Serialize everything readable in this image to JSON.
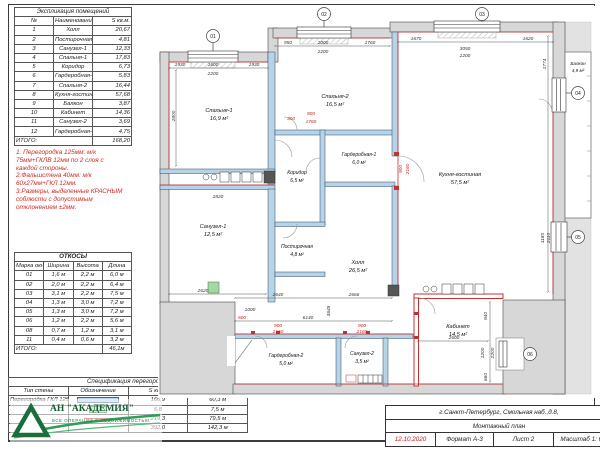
{
  "explication": {
    "title": "Экспликация помещений",
    "headers": [
      "№",
      "Наименование",
      "S кв.м."
    ],
    "rows": [
      [
        "1",
        "Холл",
        "20,67"
      ],
      [
        "2",
        "Постирочная",
        "4,81"
      ],
      [
        "3",
        "Санузел-1",
        "12,33"
      ],
      [
        "4",
        "Спальня-1",
        "17,83"
      ],
      [
        "5",
        "Коридор",
        "6,73"
      ],
      [
        "6",
        "Гардеробная-1",
        "5,83"
      ],
      [
        "7",
        "Спальня-2",
        "16,44"
      ],
      [
        "8",
        "Кухня-гостиная",
        "57,68"
      ],
      [
        "9",
        "Балкон",
        "3,87"
      ],
      [
        "10",
        "Кабинет",
        "14,36"
      ],
      [
        "11",
        "Санузел-2",
        "3,69"
      ],
      [
        "12",
        "Гардеробная-2",
        "4,75"
      ]
    ],
    "total_label": "ИТОГО:",
    "total": "168,20"
  },
  "notes": {
    "line1": "1. Перегородка 125мм: м/к",
    "line2": "75мм+ГКЛВ 12мм по 2 слоя с",
    "line3": "каждой стороны.",
    "line4": "2.Фальшстена 40мм: м/к",
    "line5": "60х27мм+ГКЛ 12мм.",
    "line6": "3.Размеры, выделенные КРАСНЫМ",
    "line7": "соблюсти  с допустимым",
    "line8": "отклонением ±2мм."
  },
  "slopes": {
    "title": "ОТКОСЫ",
    "headers": [
      "Марка окна",
      "Ширина",
      "Высота",
      "Длина"
    ],
    "rows": [
      [
        "01",
        "1,6 м",
        "2,2 м",
        "6,0 м"
      ],
      [
        "02",
        "2,0 м",
        "2,2 м",
        "6,4 м"
      ],
      [
        "03",
        "3,1 м",
        "2,2 м",
        "7,5 м"
      ],
      [
        "04",
        "1,3 м",
        "3,0 м",
        "7,2 м"
      ],
      [
        "05",
        "1,3 м",
        "3,0 м",
        "7,2 м"
      ],
      [
        "06",
        "1,2 м",
        "2,2 м",
        "5,6 м"
      ],
      [
        "08",
        "0,7 м",
        "1,2 м",
        "3,1 м"
      ],
      [
        "11",
        "0,4 м",
        "0,6 м",
        "3,2 м"
      ]
    ],
    "total_label": "ИТОГО:",
    "total": "46,1м"
  },
  "partitions_spec": {
    "title": "Спецификация перегородок",
    "headers": [
      "Тип стены",
      "Обозначение",
      "S кв.м.",
      "Длина"
    ],
    "rows": [
      {
        "type": "Перегородка ГКЛ 125мм",
        "area": "166,9",
        "length": "60,3 м"
      },
      {
        "type": "",
        "area": "5,8",
        "length": "7,5 м"
      },
      {
        "type": "",
        "area": "219,3",
        "length": "79,5 м"
      }
    ],
    "total_area": "392,0",
    "total_length": "142,3 м"
  },
  "logo": {
    "name": "АН \"АКАДЕМИЯ\"",
    "tagline": "ВСЕ ОПЕРАЦИИ С НЕДВИЖИМОСТЬЮ"
  },
  "title_block": {
    "address": "г.Санкт-Петербург, Смольная наб.,д.8,",
    "plan_name": "Монтажный план",
    "date": "12.10.2020",
    "format": "Формат А-3",
    "sheet": "Лист 2",
    "scale": "Масштаб 1: 60"
  },
  "plan": {
    "rooms": [
      {
        "name": "Спальня-1",
        "area": "16,9 м²"
      },
      {
        "name": "Спальня-2",
        "area": "16,5 м²"
      },
      {
        "name": "Кухня-гостиная",
        "area": "57,5 м²"
      },
      {
        "name": "Балкон",
        "area": "4,9 м²"
      },
      {
        "name": "Санузел-1",
        "area": "12,5 м²"
      },
      {
        "name": "Коридор",
        "area": "6,5 м²"
      },
      {
        "name": "Гардеробная-1",
        "area": "6,0 м²"
      },
      {
        "name": "Постирочная",
        "area": "4,8 м²"
      },
      {
        "name": "Холл",
        "area": "26,5 м²"
      },
      {
        "name": "Гардеробная-2",
        "area": "5,0 м²"
      },
      {
        "name": "Санузел-2",
        "area": "3,5 м²"
      },
      {
        "name": "Кабинет",
        "area": "14,5 м²"
      }
    ],
    "markers": [
      "01",
      "02",
      "03",
      "04",
      "05",
      "06"
    ],
    "dims_black": [
      "1930",
      "1600",
      "2200",
      "1930",
      "950",
      "2000",
      "2200",
      "1760",
      "1670",
      "3050",
      "2200",
      "1620",
      "2800",
      "2820",
      "2620",
      "6140",
      "2640",
      "2666",
      "3645",
      "2600",
      "940",
      "1200",
      "2200",
      "660",
      "1774",
      "1180",
      "2110",
      "1000"
    ],
    "dims_red": [
      "300",
      "900",
      "1760",
      "900",
      "2160",
      "900",
      "2160",
      "900",
      "2160",
      "500"
    ]
  }
}
